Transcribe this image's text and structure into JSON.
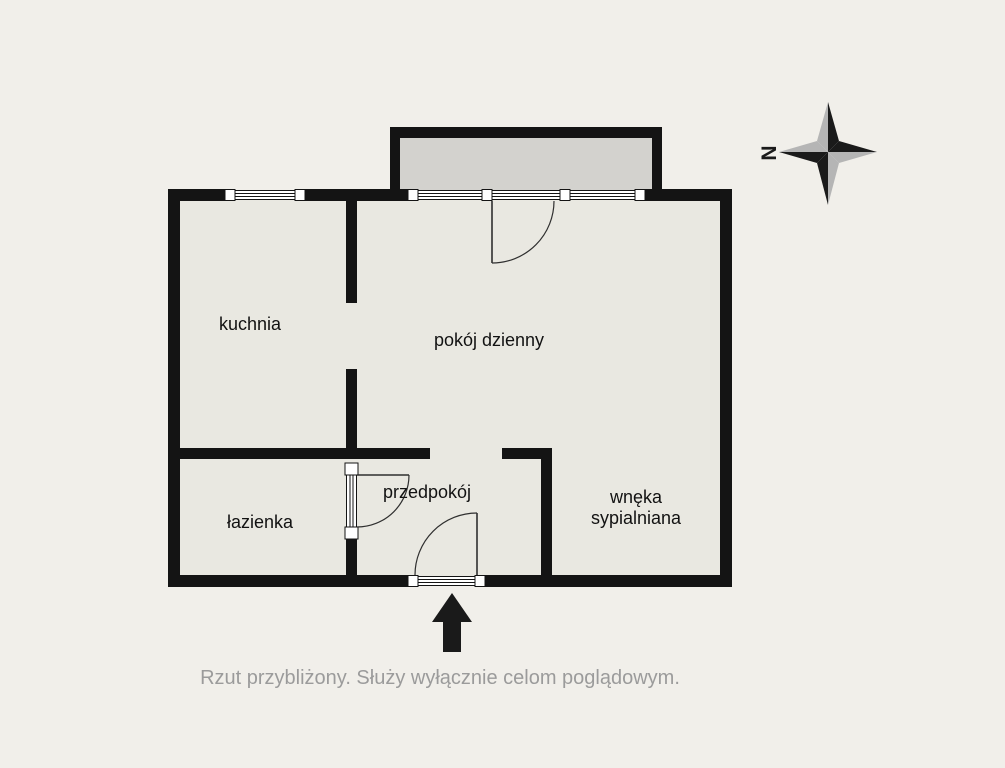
{
  "plan": {
    "rooms": {
      "kuchnia": {
        "label": "kuchnia"
      },
      "pokoj_dzienny": {
        "label": "pokój dzienny"
      },
      "lazienka": {
        "label": "łazienka"
      },
      "przedpokoj": {
        "label": "przedpokój"
      },
      "wneka": {
        "label": "wnęka sypialniana",
        "line1": "wnęka",
        "line2": "sypialniana"
      }
    },
    "features": {
      "balcony": "balkon",
      "entrance_marker": "entrance-arrow"
    }
  },
  "compass": {
    "north_label": "N"
  },
  "caption": {
    "text": "Rzut przybliżony. Służy wyłącznie celom poglądowym."
  },
  "colors": {
    "background": "#f1efea",
    "room_fill": "#e9e8e1",
    "balcony_fill": "#d3d2ce",
    "wall": "#141414",
    "caption_text": "#9b9b9b",
    "compass_dark": "#1a1a1a",
    "compass_light": "#b5b5b5"
  }
}
